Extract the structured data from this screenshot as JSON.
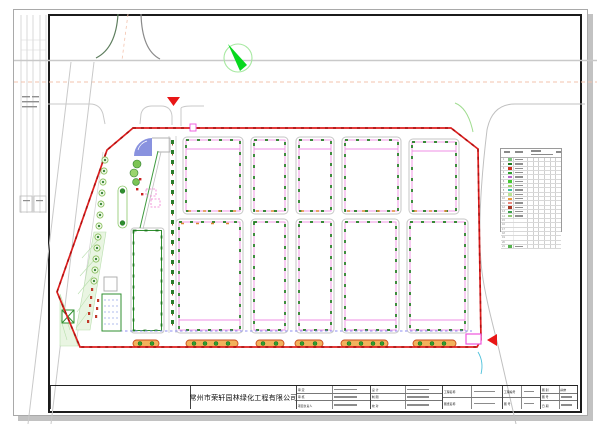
{
  "drawing": {
    "kind": "landscape-site-plan",
    "north_arrow": "compass-needle",
    "entrance_markers": [
      "red-triangle-top",
      "red-triangle-right"
    ]
  },
  "colors": {
    "boundary_red": "#dd1f1f",
    "building_outline_gray": "#c6c6c6",
    "building_inner_magenta": "#ef8fe4",
    "hedge_green": "#1d7a1d",
    "road_gray": "#c9c9c9",
    "road_centerline_pink": "#f3c3ae",
    "north_arrow_green": "#07d81e",
    "water_feature_blue": "#7c86dc",
    "lawn_green": "#e9f5e2",
    "island_fill_orange": "#f2b25c",
    "island_stroke_red": "#cc4a1a",
    "utility_dash_blue": "#8c8cf0"
  },
  "legend": {
    "rows": [
      {
        "num": "1",
        "color": "#7cc47c"
      },
      {
        "num": "2",
        "color": "#1e7a1e"
      },
      {
        "num": "3",
        "color": "#cc3322"
      },
      {
        "num": "4",
        "color": "#2fa02f"
      },
      {
        "num": "5",
        "color": "#bb66cc"
      },
      {
        "num": "6",
        "color": "#46c832"
      },
      {
        "num": "7",
        "color": "#9ed46e"
      },
      {
        "num": "8",
        "color": "#3cbfa0"
      },
      {
        "num": "9",
        "color": "#b9e494"
      },
      {
        "num": "10",
        "color": "#e89a3c"
      },
      {
        "num": "11",
        "color": "#e88a80"
      },
      {
        "num": "12",
        "color": "#a83826"
      },
      {
        "num": "13",
        "color": "#3da04d"
      },
      {
        "num": "14",
        "color": "#8fc973"
      },
      {
        "num": "15",
        "color": ""
      },
      {
        "num": "16",
        "color": ""
      },
      {
        "num": "17",
        "color": ""
      },
      {
        "num": "18",
        "color": ""
      },
      {
        "num": "19",
        "color": ""
      },
      {
        "num": "20",
        "color": ""
      },
      {
        "num": "21",
        "color": "#56b44e"
      }
    ]
  },
  "title_block": {
    "company": "常州市荣轩园林绿化工程有限公司",
    "fields": {
      "a1": "审 定",
      "a2": "审 核",
      "a3": "项目负责人",
      "b1": "设 计",
      "b2": "制 图",
      "b3": "校 对",
      "c1": "工程名称",
      "c2": "图纸名称",
      "d1": "工程编号",
      "d2": "图 号",
      "e1": "图 别",
      "e1v": "园施",
      "e2": "图 号",
      "e3": "日 期"
    }
  }
}
